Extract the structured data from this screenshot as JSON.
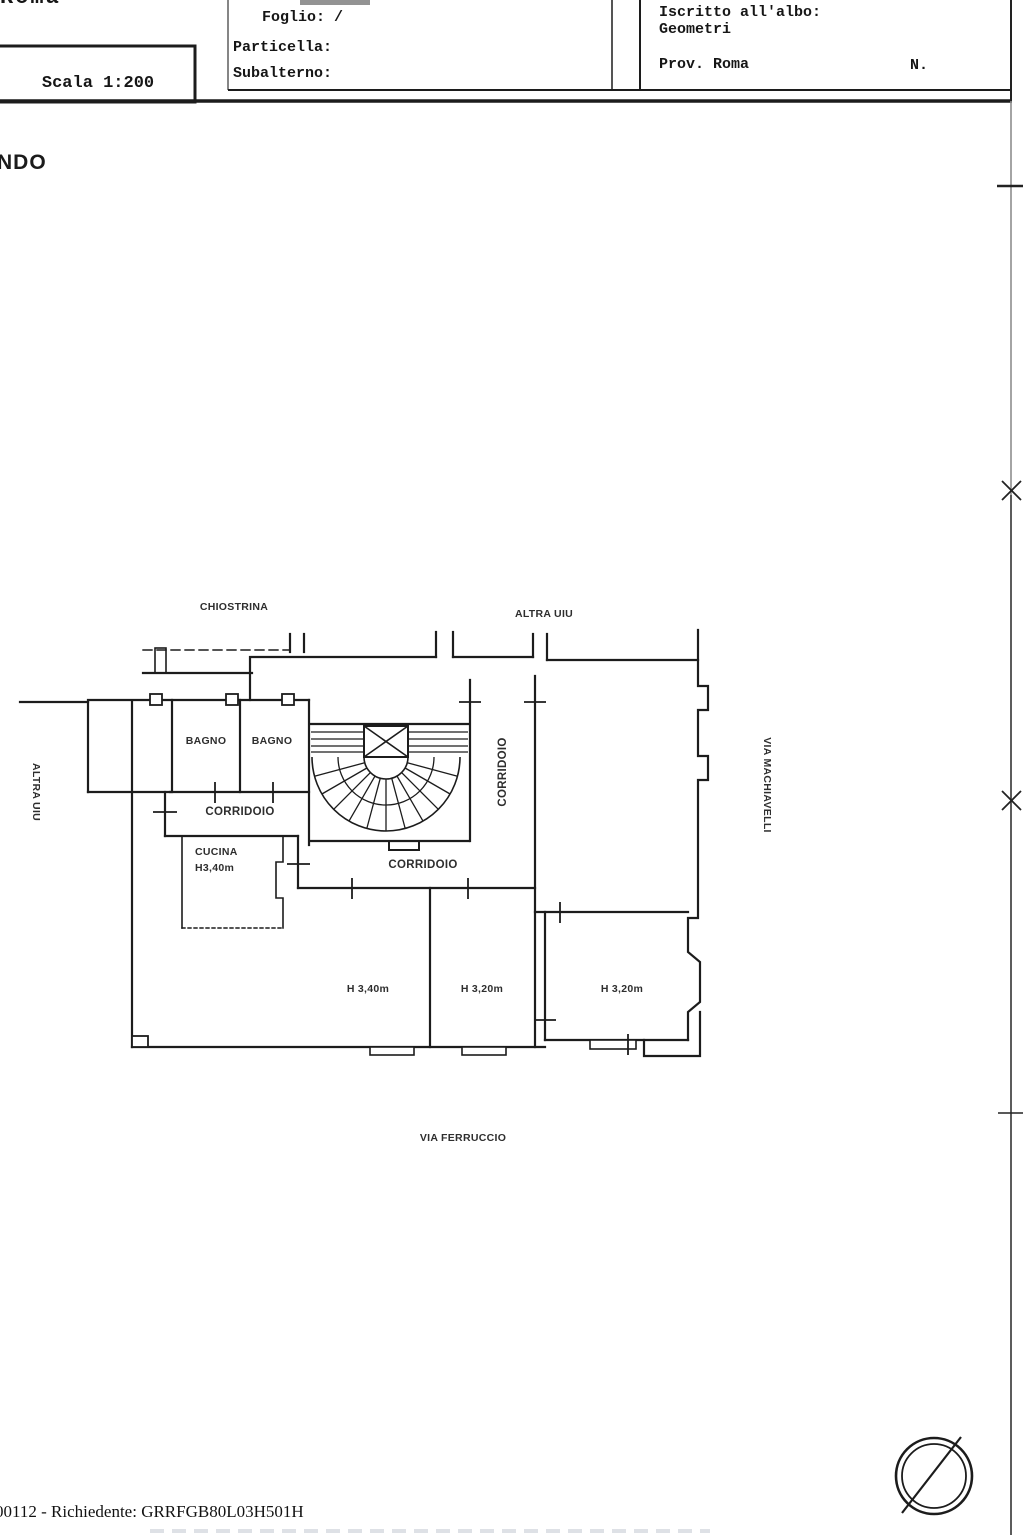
{
  "colors": {
    "ink": "#1c1c1c",
    "paper": "#ffffff"
  },
  "header": {
    "roma_fragment": "Roma",
    "scala": {
      "label": "Scala 1:200"
    },
    "cadastre": {
      "foglio": "Foglio: /",
      "particella": "Particella:",
      "subalterno": "Subalterno:"
    },
    "albo": {
      "iscritto": "Iscritto all'albo:",
      "geometri": "Geometri",
      "prov": "Prov. Roma",
      "n": "N."
    }
  },
  "page": {
    "floor_fragment": "NDO"
  },
  "plan": {
    "areas": {
      "chiostrina": "CHIOSTRINA",
      "altra_uiu_top": "ALTRA UIU",
      "altra_uiu_left": "ALTRA UIU",
      "bagno_1": "BAGNO",
      "bagno_2": "BAGNO",
      "corridoio_small": "CORRIDOIO",
      "corridoio_vertical": "CORRIDOIO",
      "corridoio_main": "CORRIDOIO",
      "cucina": "CUCINA",
      "cucina_height": "H3,40m",
      "room_1_height": "H 3,40m",
      "room_2_height": "H 3,20m",
      "room_3_height": "H 3,20m"
    },
    "streets": {
      "machiavelli": "VIA MACHIAVELLI",
      "ferruccio": "VIA FERRUCCIO"
    }
  },
  "footer": {
    "request_line": "00112 - Richiedente: GRRFGB80L03H501H"
  }
}
